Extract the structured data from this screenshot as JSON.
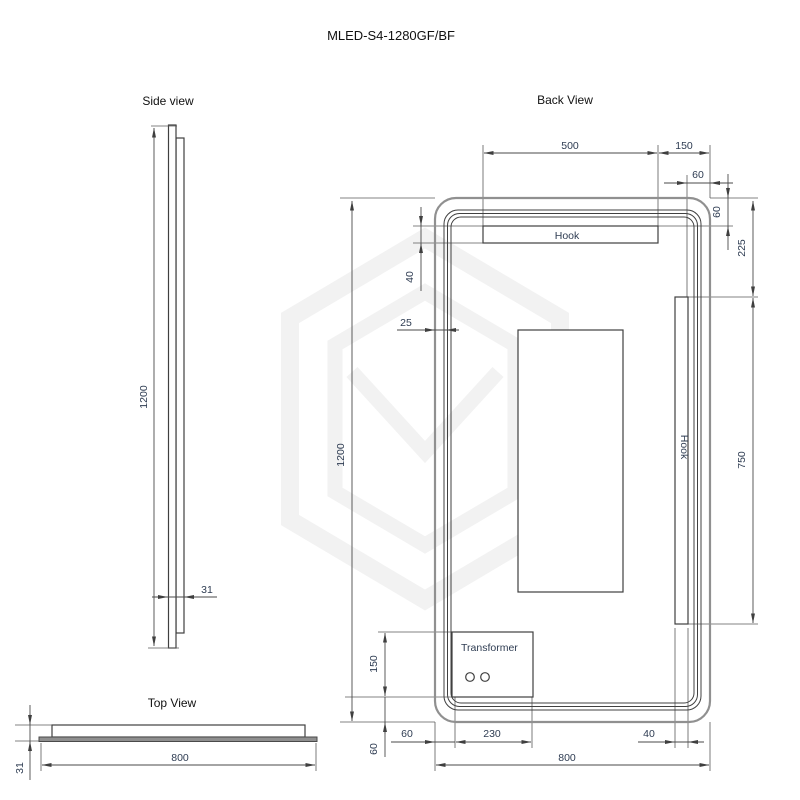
{
  "title": "MLED-S4-1280GF/BF",
  "side_view": {
    "label": "Side view",
    "height": "1200",
    "thickness": "31"
  },
  "top_view": {
    "label": "Top View",
    "width": "800",
    "thickness": "31"
  },
  "back_view": {
    "label": "Back View",
    "top_hook_label": "Hook",
    "right_hook_label": "Hook",
    "transformer_label": "Transformer",
    "dims": {
      "top_hook_width": "500",
      "hook_to_right_edge": "150",
      "corner_offset_h": "60",
      "corner_offset_v": "60",
      "hook_top_offset": "225",
      "height": "1200",
      "left_hook_height": "40",
      "frame_inset": "25",
      "right_hook_length": "750",
      "transformer_height": "150",
      "bottom_edge_offset": "60",
      "transformer_left_offset": "60",
      "transformer_width": "230",
      "right_hook_width": "40",
      "width": "800"
    }
  }
}
